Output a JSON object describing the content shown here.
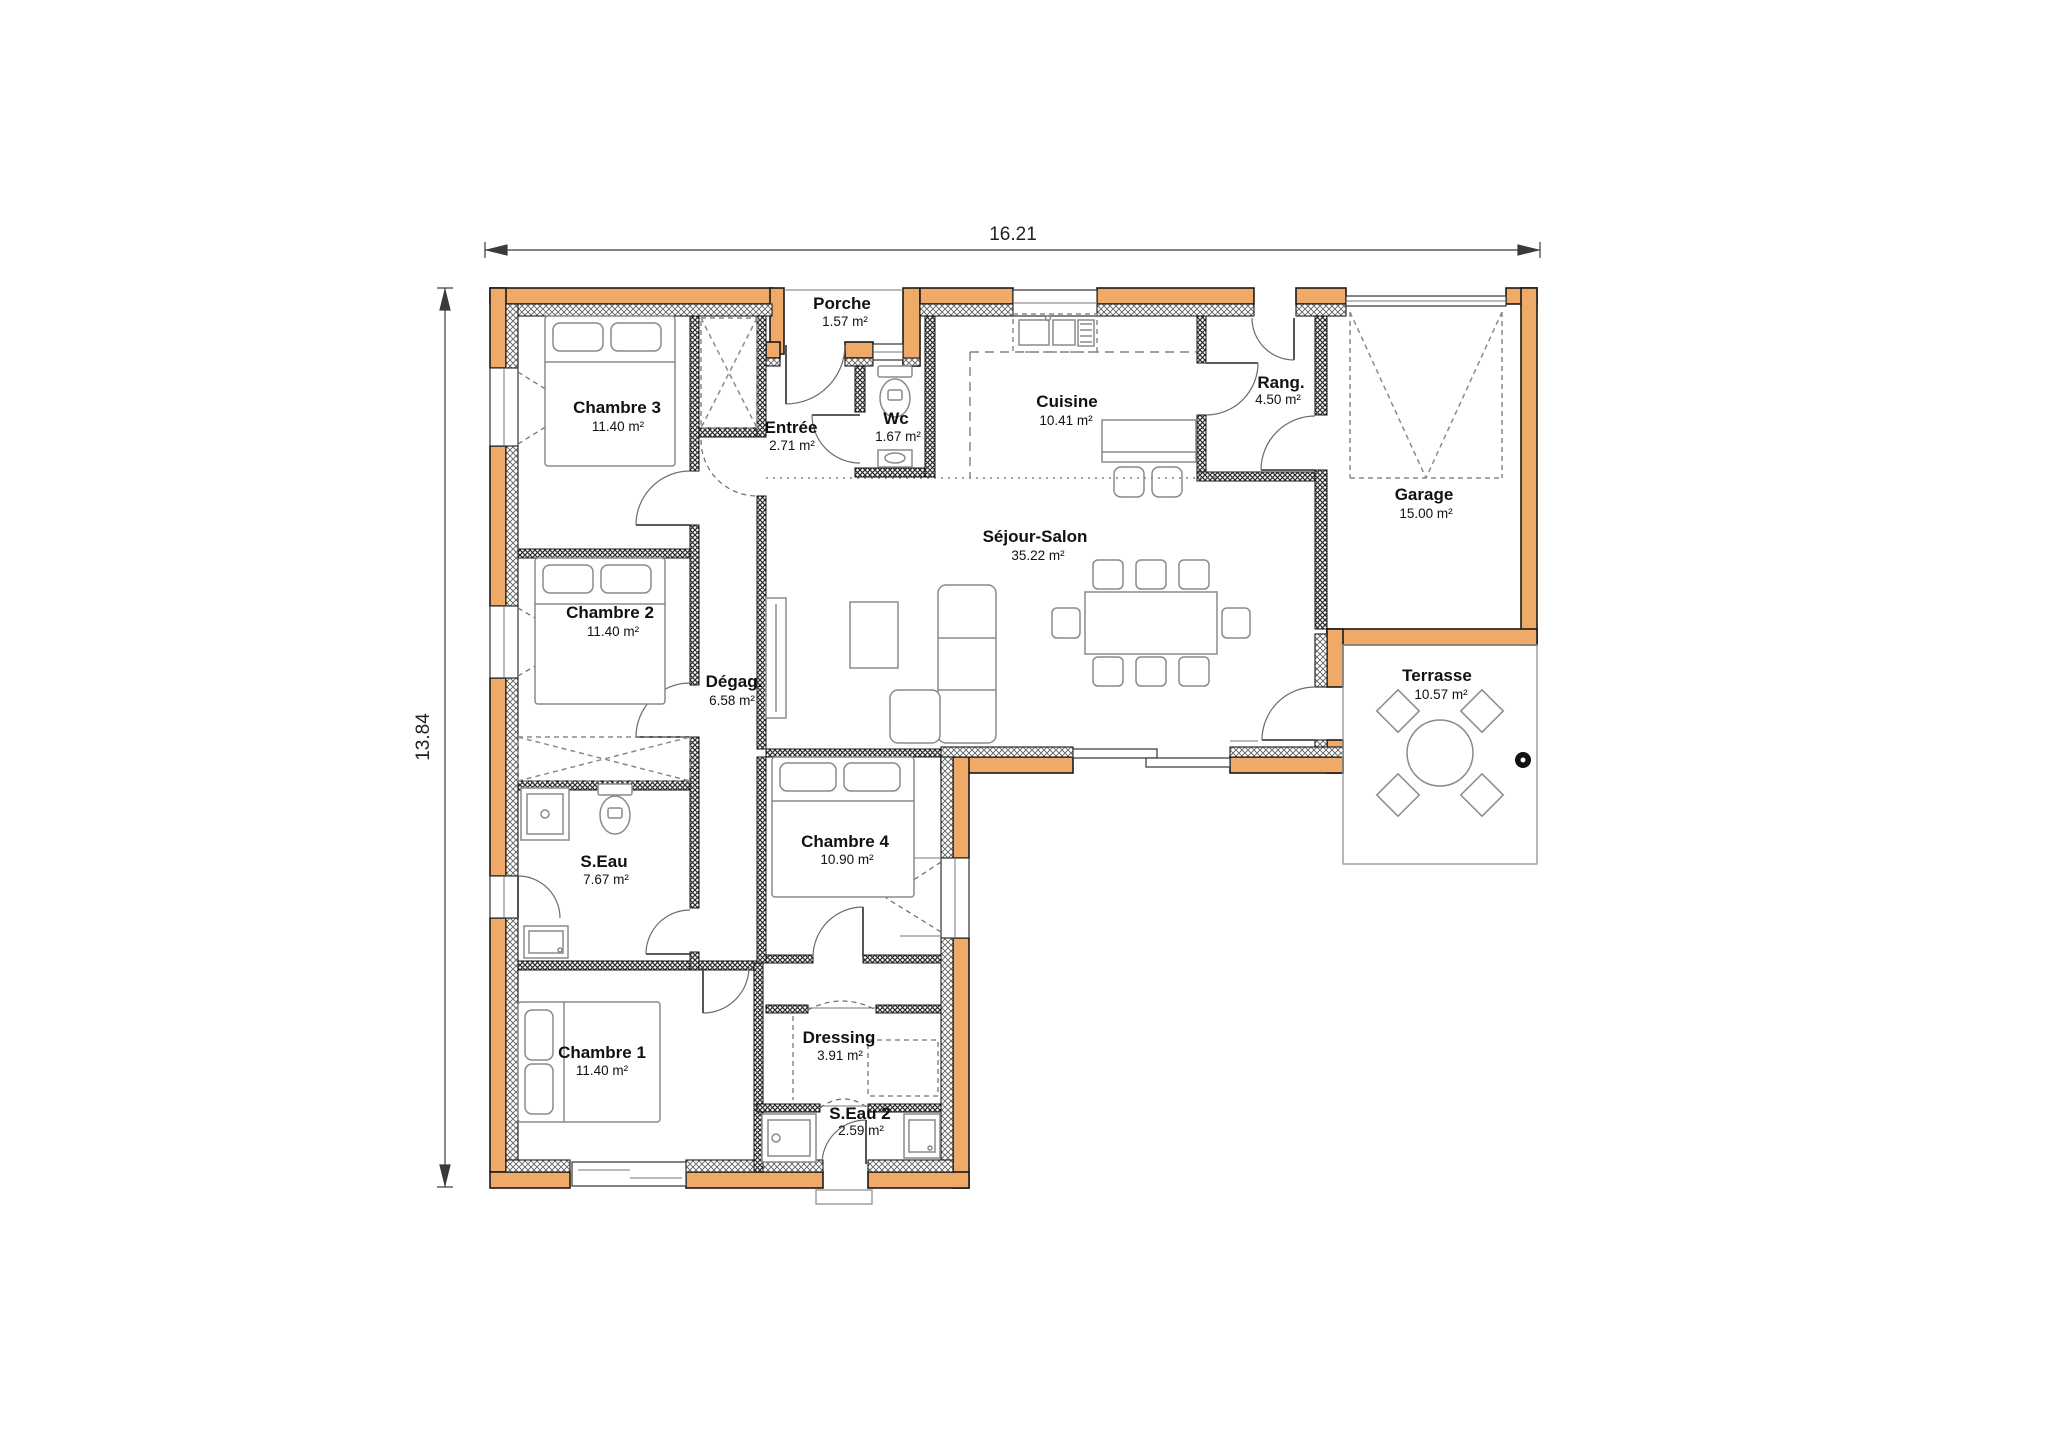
{
  "title": "Plan de maison - rez-de-chaussée",
  "dimensions": {
    "width_label": "16.21",
    "height_label": "13.84"
  },
  "rooms": [
    {
      "id": "porche",
      "name": "Porche",
      "area": "1.57 m²"
    },
    {
      "id": "chambre3",
      "name": "Chambre 3",
      "area": "11.40 m²"
    },
    {
      "id": "entree",
      "name": "Entrée",
      "area": "2.71 m²"
    },
    {
      "id": "wc",
      "name": "Wc",
      "area": "1.67 m²"
    },
    {
      "id": "cuisine",
      "name": "Cuisine",
      "area": "10.41 m²"
    },
    {
      "id": "rang",
      "name": "Rang.",
      "area": "4.50 m²"
    },
    {
      "id": "garage",
      "name": "Garage",
      "area": "15.00 m²"
    },
    {
      "id": "chambre2",
      "name": "Chambre 2",
      "area": "11.40 m²"
    },
    {
      "id": "degag",
      "name": "Dégag.",
      "area": "6.58 m²"
    },
    {
      "id": "sejour",
      "name": "Séjour-Salon",
      "area": "35.22 m²"
    },
    {
      "id": "terrasse",
      "name": "Terrasse",
      "area": "10.57 m²"
    },
    {
      "id": "seau",
      "name": "S.Eau",
      "area": "7.67 m²"
    },
    {
      "id": "chambre4",
      "name": "Chambre 4",
      "area": "10.90 m²"
    },
    {
      "id": "chambre1",
      "name": "Chambre 1",
      "area": "11.40 m²"
    },
    {
      "id": "dressing",
      "name": "Dressing",
      "area": "3.91 m²"
    },
    {
      "id": "seau2",
      "name": "S.Eau 2",
      "area": "2.59 m²"
    }
  ],
  "colors": {
    "wall_fill": "#eeaa66",
    "wall_outline": "#1a1a1a",
    "hatch": "#5f5f5f",
    "interior_hatch": "#2b2b2b",
    "furniture": "#8a8a8a",
    "text": "#111111",
    "dimension": "#3a3a3a",
    "background": "#ffffff"
  }
}
